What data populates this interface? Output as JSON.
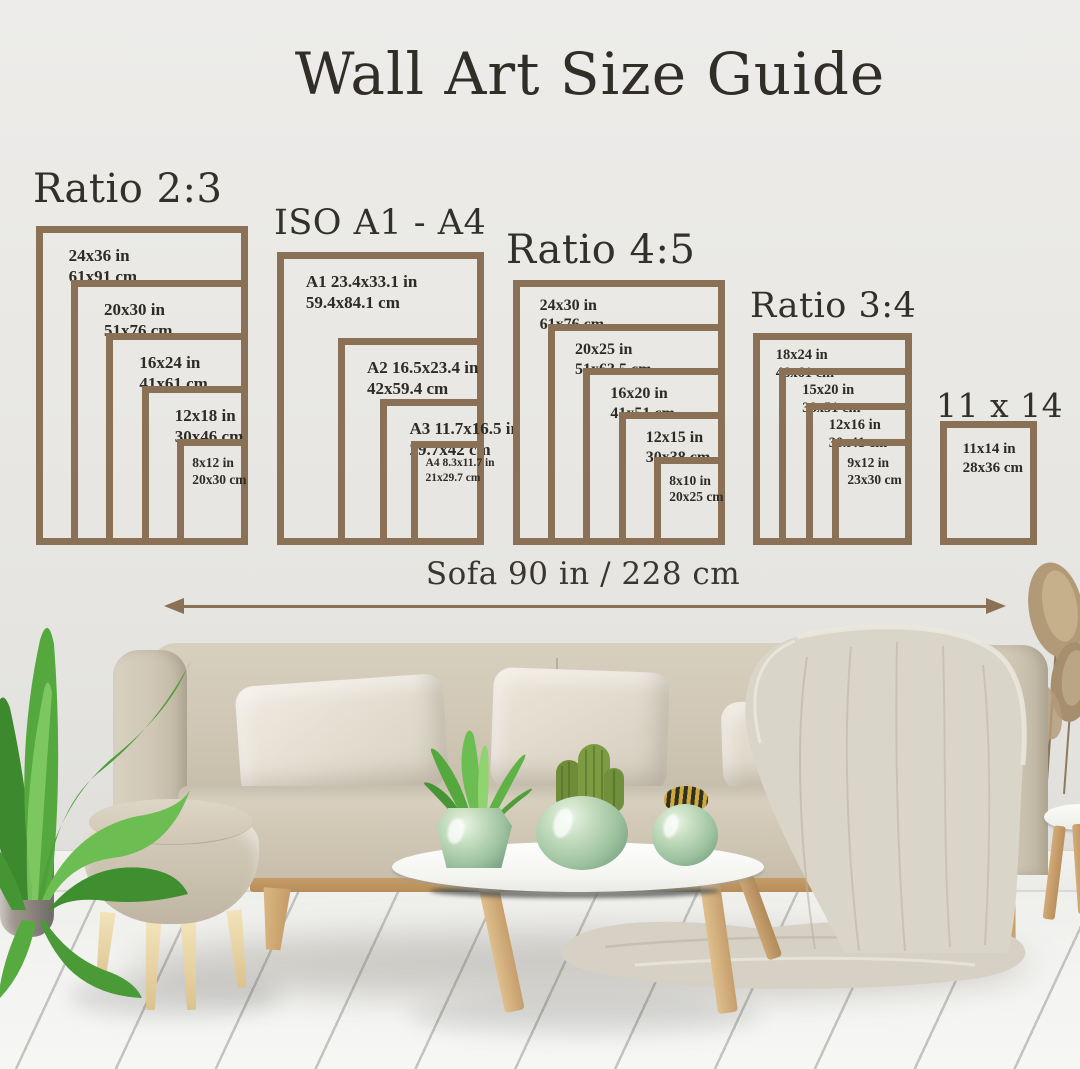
{
  "title": "Wall Art Size Guide",
  "sofa_measure_label": "Sofa 90 in / 228 cm",
  "colors": {
    "frame_brown": "#8a7156",
    "ink": "#2e2a24",
    "wall": "#e9e8e4"
  },
  "size_groups": [
    {
      "id": "ratio-2-3",
      "heading": "Ratio 2:3",
      "frames": [
        {
          "inches": "24x36 in",
          "cm": "61x91 cm",
          "w_in": 24,
          "h_in": 36
        },
        {
          "inches": "20x30 in",
          "cm": "51x76 cm",
          "w_in": 20,
          "h_in": 30
        },
        {
          "inches": "16x24 in",
          "cm": "41x61 cm",
          "w_in": 16,
          "h_in": 24
        },
        {
          "inches": "12x18 in",
          "cm": "30x46 cm",
          "w_in": 12,
          "h_in": 18
        },
        {
          "inches": "8x12 in",
          "cm": "20x30 cm",
          "w_in": 8,
          "h_in": 12
        }
      ]
    },
    {
      "id": "iso-a1-a4",
      "heading": "ISO A1 - A4",
      "frames": [
        {
          "inches": "A1 23.4x33.1 in",
          "cm": "59.4x84.1 cm",
          "w_in": 23.4,
          "h_in": 33.1
        },
        {
          "inches": "A2 16.5x23.4 in",
          "cm": "42x59.4 cm",
          "w_in": 16.5,
          "h_in": 23.4
        },
        {
          "inches": "A3 11.7x16.5 in",
          "cm": "29.7x42 cm",
          "w_in": 11.7,
          "h_in": 16.5
        },
        {
          "inches": "A4 8.3x11.7 in",
          "cm": "21x29.7 cm",
          "w_in": 8.3,
          "h_in": 11.7,
          "small": true
        }
      ]
    },
    {
      "id": "ratio-4-5",
      "heading": "Ratio 4:5",
      "frames": [
        {
          "inches": "24x30 in",
          "cm": "61x76 cm",
          "w_in": 24,
          "h_in": 30
        },
        {
          "inches": "20x25 in",
          "cm": "51x63.5 cm",
          "w_in": 20,
          "h_in": 25
        },
        {
          "inches": "16x20 in",
          "cm": "41x51 cm",
          "w_in": 16,
          "h_in": 20
        },
        {
          "inches": "12x15 in",
          "cm": "30x38 cm",
          "w_in": 12,
          "h_in": 15
        },
        {
          "inches": "8x10 in",
          "cm": "20x25 cm",
          "w_in": 8,
          "h_in": 10
        }
      ]
    },
    {
      "id": "ratio-3-4",
      "heading": "Ratio 3:4",
      "frames": [
        {
          "inches": "18x24 in",
          "cm": "46x61 cm",
          "w_in": 18,
          "h_in": 24
        },
        {
          "inches": "15x20 in",
          "cm": "38x51 cm",
          "w_in": 15,
          "h_in": 20
        },
        {
          "inches": "12x16 in",
          "cm": "30x41 cm",
          "w_in": 12,
          "h_in": 16
        },
        {
          "inches": "9x12 in",
          "cm": "23x30 cm",
          "w_in": 9,
          "h_in": 12
        }
      ]
    },
    {
      "id": "size-11x14",
      "heading": "11 x 14",
      "frames": [
        {
          "inches": "11x14 in",
          "cm": "28x36 cm",
          "w_in": 11,
          "h_in": 14
        }
      ]
    }
  ]
}
